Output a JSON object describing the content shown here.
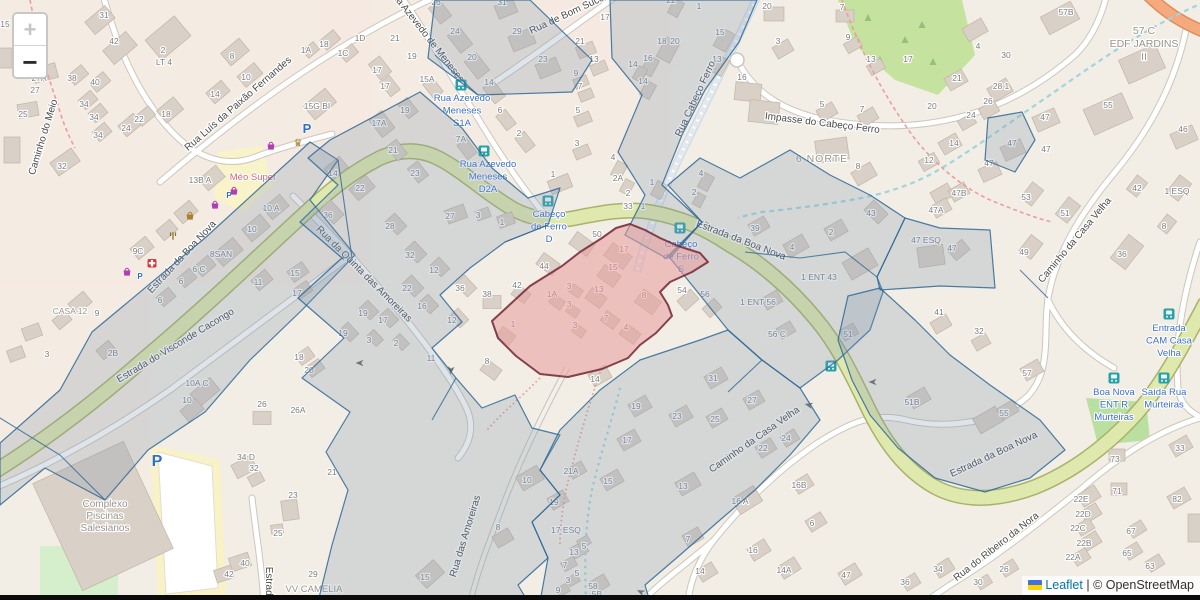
{
  "ui": {
    "zoom_in_label": "+",
    "zoom_out_label": "−"
  },
  "attribution": {
    "flag_icon": "ukraine-flag",
    "leaflet_label": "Leaflet",
    "separator": " | ",
    "osm_label": "© OpenStreetMap"
  },
  "colors": {
    "overlay_blue_fill": "#7e97ad",
    "overlay_blue_stroke": "#2e6796",
    "highlight_red_fill": "#e89b9b",
    "highlight_red_stroke": "#7b2d3e",
    "road_green_fill": "#dfe9ad",
    "road_green_casing": "#a9b26a",
    "road_orange_fill": "#f5a97e",
    "road_orange_casing": "#dd8f55",
    "bus_teal": "#2aa0a8",
    "bus_label_blue": "#3b6fc0",
    "shop_purple": "#b13cb3",
    "shop_gold": "#a9802f",
    "parking_blue": "#2f6fc4",
    "pharmacy_red": "#cf3d3d",
    "number_gray": "#7d7d7d",
    "street_gray": "#4a4a4a",
    "place_gray": "#9a948a",
    "supermarket_pink": "#d56770",
    "stream_blue": "#9fd4e0",
    "path_red_dash": "#ee9d9d"
  },
  "map": {
    "street_labels": [
      {
        "t": "Caminho do Meio",
        "x": 46,
        "y": 138,
        "r": -73
      },
      {
        "t": "Rua Luís da Paixão Fernandes",
        "x": 240,
        "y": 106,
        "r": -41
      },
      {
        "t": "Rua Azevedo de Meneses",
        "x": 424,
        "y": 37,
        "r": 52
      },
      {
        "t": "Rua de Bom Suce",
        "x": 568,
        "y": 17,
        "r": -25
      },
      {
        "t": "Impasse do Cabeço Ferro",
        "x": 822,
        "y": 126,
        "r": 7
      },
      {
        "t": "Rua Cabeço Ferro",
        "x": 698,
        "y": 100,
        "r": -65
      },
      {
        "t": "Estrada da Boa Nova",
        "x": 184,
        "y": 259,
        "r": -47
      },
      {
        "t": "Estrada da Boa Nova",
        "x": 740,
        "y": 243,
        "r": 21
      },
      {
        "t": "Estrada da Boa Nova",
        "x": 995,
        "y": 457,
        "r": -25
      },
      {
        "t": "Estrada do Visconde Cacongo",
        "x": 177,
        "y": 348,
        "r": -31
      },
      {
        "t": "Rua da Quinta das Amoreiras",
        "x": 362,
        "y": 276,
        "r": 45
      },
      {
        "t": "Rua das Amoreiras",
        "x": 468,
        "y": 537,
        "r": -73
      },
      {
        "t": "Caminho da Casa Velha",
        "x": 1077,
        "y": 242,
        "r": -50
      },
      {
        "t": "Caminho da Casa Velha",
        "x": 756,
        "y": 442,
        "r": -35
      },
      {
        "t": "Rua do Ribeiro da Nora",
        "x": 998,
        "y": 549,
        "r": -38
      },
      {
        "t": "Estrada",
        "x": 266,
        "y": 584,
        "r": 90
      }
    ],
    "place_labels": [
      {
        "lines": [
          "Complexo",
          "Piscinas",
          "Salesianos"
        ],
        "x": 105,
        "y": 507,
        "lh": 12,
        "size": 10
      },
      {
        "lines": [
          "6 NORTE"
        ],
        "x": 822,
        "y": 162,
        "lh": 12,
        "size": 10.5,
        "ls": 1
      },
      {
        "lines": [
          "57 C",
          "EDF JARDINS",
          "II"
        ],
        "x": 1144,
        "y": 34,
        "lh": 13,
        "size": 10.5
      },
      {
        "lines": [
          "VV CAMELIA"
        ],
        "x": 314,
        "y": 592,
        "lh": 12,
        "size": 9.5
      },
      {
        "lines": [
          "CASA 12"
        ],
        "x": 70,
        "y": 314,
        "lh": 11,
        "size": 8.5
      }
    ],
    "supermarket_label": {
      "t": "Méo Super",
      "x": 253,
      "y": 180
    },
    "bus_stops": [
      {
        "lines": [
          "Cabeço",
          "de Ferro",
          "D"
        ],
        "x": 549,
        "y": 217,
        "ix": 548,
        "iy": 201
      },
      {
        "lines": [
          "Cabeço",
          "de Ferro",
          "S"
        ],
        "x": 681,
        "y": 247,
        "ix": 680,
        "iy": 228
      },
      {
        "lines": [
          "Rua Azevedo",
          "Meneses",
          "S1A"
        ],
        "x": 462,
        "y": 101,
        "ix": 461,
        "iy": 85
      },
      {
        "lines": [
          "Rua Azevedo",
          "Meneses",
          "D2A"
        ],
        "x": 488,
        "y": 167,
        "ix": 484,
        "iy": 151
      },
      {
        "lines": [
          "Entrada",
          "CAM Casa",
          "Velha"
        ],
        "x": 1169,
        "y": 331,
        "ix": 1169,
        "iy": 314
      },
      {
        "lines": [
          "Boa Nova",
          "ENT R",
          "Murteiras"
        ],
        "x": 1114,
        "y": 395,
        "ix": 1114,
        "iy": 378
      },
      {
        "lines": [
          "Saída Rua",
          "Murteiras"
        ],
        "x": 1164,
        "y": 395,
        "ix": 1164,
        "iy": 378
      }
    ],
    "bus_icons_on_road": [
      [
        831,
        366
      ]
    ],
    "pois": [
      {
        "t": "parking",
        "x": 307,
        "y": 133,
        "s": 13
      },
      {
        "t": "parking",
        "x": 157,
        "y": 466,
        "s": 16
      },
      {
        "t": "parking",
        "x": 229,
        "y": 198,
        "s": 8
      },
      {
        "t": "parking",
        "x": 140,
        "y": 279,
        "s": 8
      },
      {
        "t": "bag",
        "x": 271,
        "y": 146
      },
      {
        "t": "crown",
        "x": 298,
        "y": 143
      },
      {
        "t": "bag",
        "x": 234,
        "y": 191
      },
      {
        "t": "bag",
        "x": 215,
        "y": 205
      },
      {
        "t": "basket",
        "x": 190,
        "y": 216
      },
      {
        "t": "fork",
        "x": 173,
        "y": 236
      },
      {
        "t": "pharmacy",
        "x": 152,
        "y": 263
      },
      {
        "t": "bag",
        "x": 127,
        "y": 272
      }
    ],
    "arrows": [
      {
        "x": 360,
        "y": 363,
        "a": 180
      },
      {
        "x": 451,
        "y": 370,
        "a": 95
      },
      {
        "x": 809,
        "y": 405,
        "a": 195
      },
      {
        "x": 641,
        "y": 592,
        "a": 205
      },
      {
        "x": 873,
        "y": 382,
        "a": 180
      }
    ],
    "house_numbers": [
      [
        "15",
        5,
        27
      ],
      [
        "31",
        104,
        18
      ],
      [
        "42",
        114,
        44
      ],
      [
        "2",
        163,
        53
      ],
      [
        "LT 4",
        164,
        65
      ],
      [
        "8",
        232,
        59
      ],
      [
        "10",
        246,
        80
      ],
      [
        "14",
        215,
        97
      ],
      [
        "27A",
        39,
        81
      ],
      [
        "27",
        35,
        93
      ],
      [
        "38",
        72,
        81
      ],
      [
        "40",
        95,
        85
      ],
      [
        "25",
        23,
        117
      ],
      [
        "34",
        84,
        107
      ],
      [
        "34",
        94,
        120
      ],
      [
        "34",
        98,
        138
      ],
      [
        "24",
        126,
        131
      ],
      [
        "22",
        139,
        122
      ],
      [
        "18",
        166,
        117
      ],
      [
        "32",
        62,
        169
      ],
      [
        "13B A",
        200,
        183
      ],
      [
        "26",
        436,
        5
      ],
      [
        "31",
        502,
        5
      ],
      [
        "24",
        455,
        34
      ],
      [
        "29",
        517,
        34
      ],
      [
        "20",
        472,
        60
      ],
      [
        "23",
        543,
        62
      ],
      [
        "21",
        395,
        41
      ],
      [
        "19",
        412,
        59
      ],
      [
        "15A",
        427,
        82
      ],
      [
        "14",
        489,
        85
      ],
      [
        "21",
        580,
        44
      ],
      [
        "13",
        594,
        62
      ],
      [
        "9",
        576,
        76
      ],
      [
        "7",
        580,
        89
      ],
      [
        "6",
        500,
        113
      ],
      [
        "5",
        578,
        113
      ],
      [
        "2",
        519,
        136
      ],
      [
        "3",
        577,
        146
      ],
      [
        "1",
        553,
        177
      ],
      [
        "7A",
        461,
        142
      ],
      [
        "1A",
        306,
        53
      ],
      [
        "18",
        324,
        47
      ],
      [
        "1D",
        360,
        41
      ],
      [
        "1C",
        343,
        56
      ],
      [
        "15G BI",
        317,
        109
      ],
      [
        "17",
        377,
        73
      ],
      [
        "17",
        385,
        89
      ],
      [
        "19",
        405,
        113
      ],
      [
        "17A",
        379,
        126
      ],
      [
        "21",
        393,
        153
      ],
      [
        "23",
        415,
        176
      ],
      [
        "14",
        333,
        176
      ],
      [
        "22",
        360,
        191
      ],
      [
        "22",
        671,
        3
      ],
      [
        "1",
        699,
        9
      ],
      [
        "20",
        767,
        9
      ],
      [
        "7",
        842,
        10
      ],
      [
        "15",
        720,
        35
      ],
      [
        "3",
        778,
        44
      ],
      [
        "9",
        848,
        40
      ],
      [
        "13",
        717,
        62
      ],
      [
        "13",
        871,
        62
      ],
      [
        "16",
        742,
        80
      ],
      [
        "18",
        662,
        44
      ],
      [
        "20",
        675,
        44
      ],
      [
        "16",
        648,
        61
      ],
      [
        "14",
        633,
        67
      ],
      [
        "14",
        643,
        84
      ],
      [
        "17",
        605,
        20
      ],
      [
        "5",
        822,
        107
      ],
      [
        "7",
        862,
        112
      ],
      [
        "8",
        858,
        169
      ],
      [
        "4",
        613,
        160
      ],
      [
        "2A",
        618,
        181
      ],
      [
        "1",
        652,
        185
      ],
      [
        "4",
        701,
        176
      ],
      [
        "2",
        694,
        195
      ],
      [
        "2",
        628,
        196
      ],
      [
        "57B",
        1066,
        15
      ],
      [
        "4",
        978,
        49
      ],
      [
        "30",
        1006,
        58
      ],
      [
        "17",
        908,
        62
      ],
      [
        "21",
        957,
        81
      ],
      [
        "28 1",
        1001,
        89
      ],
      [
        "26",
        988,
        104
      ],
      [
        "24",
        971,
        118
      ],
      [
        "20",
        932,
        109
      ],
      [
        "14",
        954,
        146
      ],
      [
        "12",
        929,
        163
      ],
      [
        "55",
        1108,
        108
      ],
      [
        "47",
        1045,
        120
      ],
      [
        "47",
        1012,
        146
      ],
      [
        "47",
        1046,
        152
      ],
      [
        "46",
        1183,
        132
      ],
      [
        "47",
        989,
        166
      ],
      [
        "47B",
        959,
        196
      ],
      [
        "42",
        1137,
        191
      ],
      [
        "1 ESQ",
        1177,
        194
      ],
      [
        "10 A",
        271,
        211
      ],
      [
        "10",
        252,
        232
      ],
      [
        "9C",
        138,
        254
      ],
      [
        "8SAN",
        221,
        257
      ],
      [
        "6 C",
        199,
        272
      ],
      [
        "6",
        181,
        284
      ],
      [
        "6",
        160,
        303
      ],
      [
        "11",
        258,
        285
      ],
      [
        "15",
        295,
        276
      ],
      [
        "17",
        297,
        296
      ],
      [
        "36",
        328,
        218
      ],
      [
        "9",
        97,
        316
      ],
      [
        "2B",
        113,
        356
      ],
      [
        "3",
        47,
        357
      ],
      [
        "50",
        597,
        237
      ],
      [
        "44",
        544,
        269
      ],
      [
        "42",
        517,
        288
      ],
      [
        "38",
        487,
        297
      ],
      [
        "54",
        682,
        293
      ],
      [
        "56",
        705,
        297
      ],
      [
        "33",
        628,
        209
      ],
      [
        "1",
        643,
        209
      ],
      [
        "17",
        624,
        252
      ],
      [
        "15",
        613,
        270
      ],
      [
        "13",
        599,
        292
      ],
      [
        "8",
        644,
        298
      ],
      [
        "7",
        606,
        321
      ],
      [
        "4",
        626,
        330
      ],
      [
        "3",
        569,
        289
      ],
      [
        "1A",
        552,
        297
      ],
      [
        "3",
        569,
        307
      ],
      [
        "3",
        575,
        328
      ],
      [
        "1",
        513,
        327
      ],
      [
        "43",
        871,
        216
      ],
      [
        "39",
        755,
        231
      ],
      [
        "4",
        792,
        250
      ],
      [
        "2",
        831,
        235
      ],
      [
        "1 ENT 43",
        819,
        280
      ],
      [
        "47 ESQ",
        926,
        243
      ],
      [
        "47",
        952,
        251
      ],
      [
        "47A",
        936,
        213
      ],
      [
        "1 ENT 56",
        758,
        305
      ],
      [
        "56 C",
        777,
        337
      ],
      [
        "51",
        848,
        337
      ],
      [
        "41",
        939,
        315
      ],
      [
        "32",
        979,
        334
      ],
      [
        "53",
        1026,
        200
      ],
      [
        "51",
        1065,
        216
      ],
      [
        "49",
        1024,
        255
      ],
      [
        "8",
        1164,
        229
      ],
      [
        "36",
        1122,
        257
      ],
      [
        "57",
        1027,
        376
      ],
      [
        "55",
        1004,
        416
      ],
      [
        "10A C",
        197,
        386
      ],
      [
        "10",
        187,
        403
      ],
      [
        "26",
        262,
        407
      ],
      [
        "26A",
        298,
        413
      ],
      [
        "34 D",
        246,
        460
      ],
      [
        "32",
        254,
        471
      ],
      [
        "23",
        293,
        498
      ],
      [
        "25",
        278,
        536
      ],
      [
        "40",
        245,
        566
      ],
      [
        "42",
        229,
        577
      ],
      [
        "29",
        313,
        577
      ],
      [
        "21",
        332,
        475
      ],
      [
        "15",
        425,
        580
      ],
      [
        "10",
        527,
        483
      ],
      [
        "19",
        554,
        505
      ],
      [
        "8",
        498,
        530
      ],
      [
        "17 ESQ",
        566,
        533
      ],
      [
        "13",
        574,
        555
      ],
      [
        "7",
        565,
        568
      ],
      [
        "5",
        584,
        549
      ],
      [
        "5",
        577,
        576
      ],
      [
        "3",
        568,
        583
      ],
      [
        "9",
        558,
        593
      ],
      [
        "58",
        593,
        589
      ],
      [
        "5B",
        597,
        597
      ],
      [
        "15",
        608,
        484
      ],
      [
        "7",
        688,
        542
      ],
      [
        "13",
        683,
        489
      ],
      [
        "14",
        700,
        574
      ],
      [
        "14",
        595,
        382
      ],
      [
        "31",
        713,
        381
      ],
      [
        "19",
        636,
        409
      ],
      [
        "23",
        677,
        419
      ],
      [
        "25",
        715,
        422
      ],
      [
        "27",
        752,
        403
      ],
      [
        "17",
        627,
        443
      ],
      [
        "21A",
        571,
        474
      ],
      [
        "22",
        763,
        451
      ],
      [
        "24",
        786,
        441
      ],
      [
        "16B",
        799,
        488
      ],
      [
        "16 A",
        740,
        504
      ],
      [
        "6",
        812,
        526
      ],
      [
        "16",
        753,
        553
      ],
      [
        "14A",
        784,
        573
      ],
      [
        "47",
        846,
        578
      ],
      [
        "51B",
        912,
        405
      ],
      [
        "73",
        1115,
        462
      ],
      [
        "71",
        1117,
        494
      ],
      [
        "33",
        1180,
        451
      ],
      [
        "82",
        1177,
        502
      ],
      [
        "22E",
        1081,
        502
      ],
      [
        "22D",
        1083,
        517
      ],
      [
        "22C",
        1078,
        531
      ],
      [
        "22B",
        1084,
        546
      ],
      [
        "22A",
        1073,
        560
      ],
      [
        "67",
        1131,
        534
      ],
      [
        "65",
        1127,
        556
      ],
      [
        "63",
        1150,
        569
      ],
      [
        "34",
        938,
        572
      ],
      [
        "36",
        905,
        585
      ],
      [
        "26",
        1004,
        572
      ],
      [
        "30",
        978,
        585
      ],
      [
        "28",
        390,
        229
      ],
      [
        "27",
        450,
        219
      ],
      [
        "3",
        478,
        218
      ],
      [
        "1",
        502,
        225
      ],
      [
        "32",
        410,
        258
      ],
      [
        "12",
        434,
        273
      ],
      [
        "22",
        407,
        291
      ],
      [
        "36",
        460,
        291
      ],
      [
        "16",
        422,
        309
      ],
      [
        "12",
        452,
        323
      ],
      [
        "19",
        363,
        316
      ],
      [
        "17",
        383,
        323
      ],
      [
        "19",
        343,
        336
      ],
      [
        "3",
        369,
        343
      ],
      [
        "2",
        396,
        346
      ],
      [
        "11",
        431,
        361
      ],
      [
        "18",
        299,
        360
      ],
      [
        "20",
        309,
        373
      ],
      [
        "8",
        487,
        364
      ]
    ]
  }
}
